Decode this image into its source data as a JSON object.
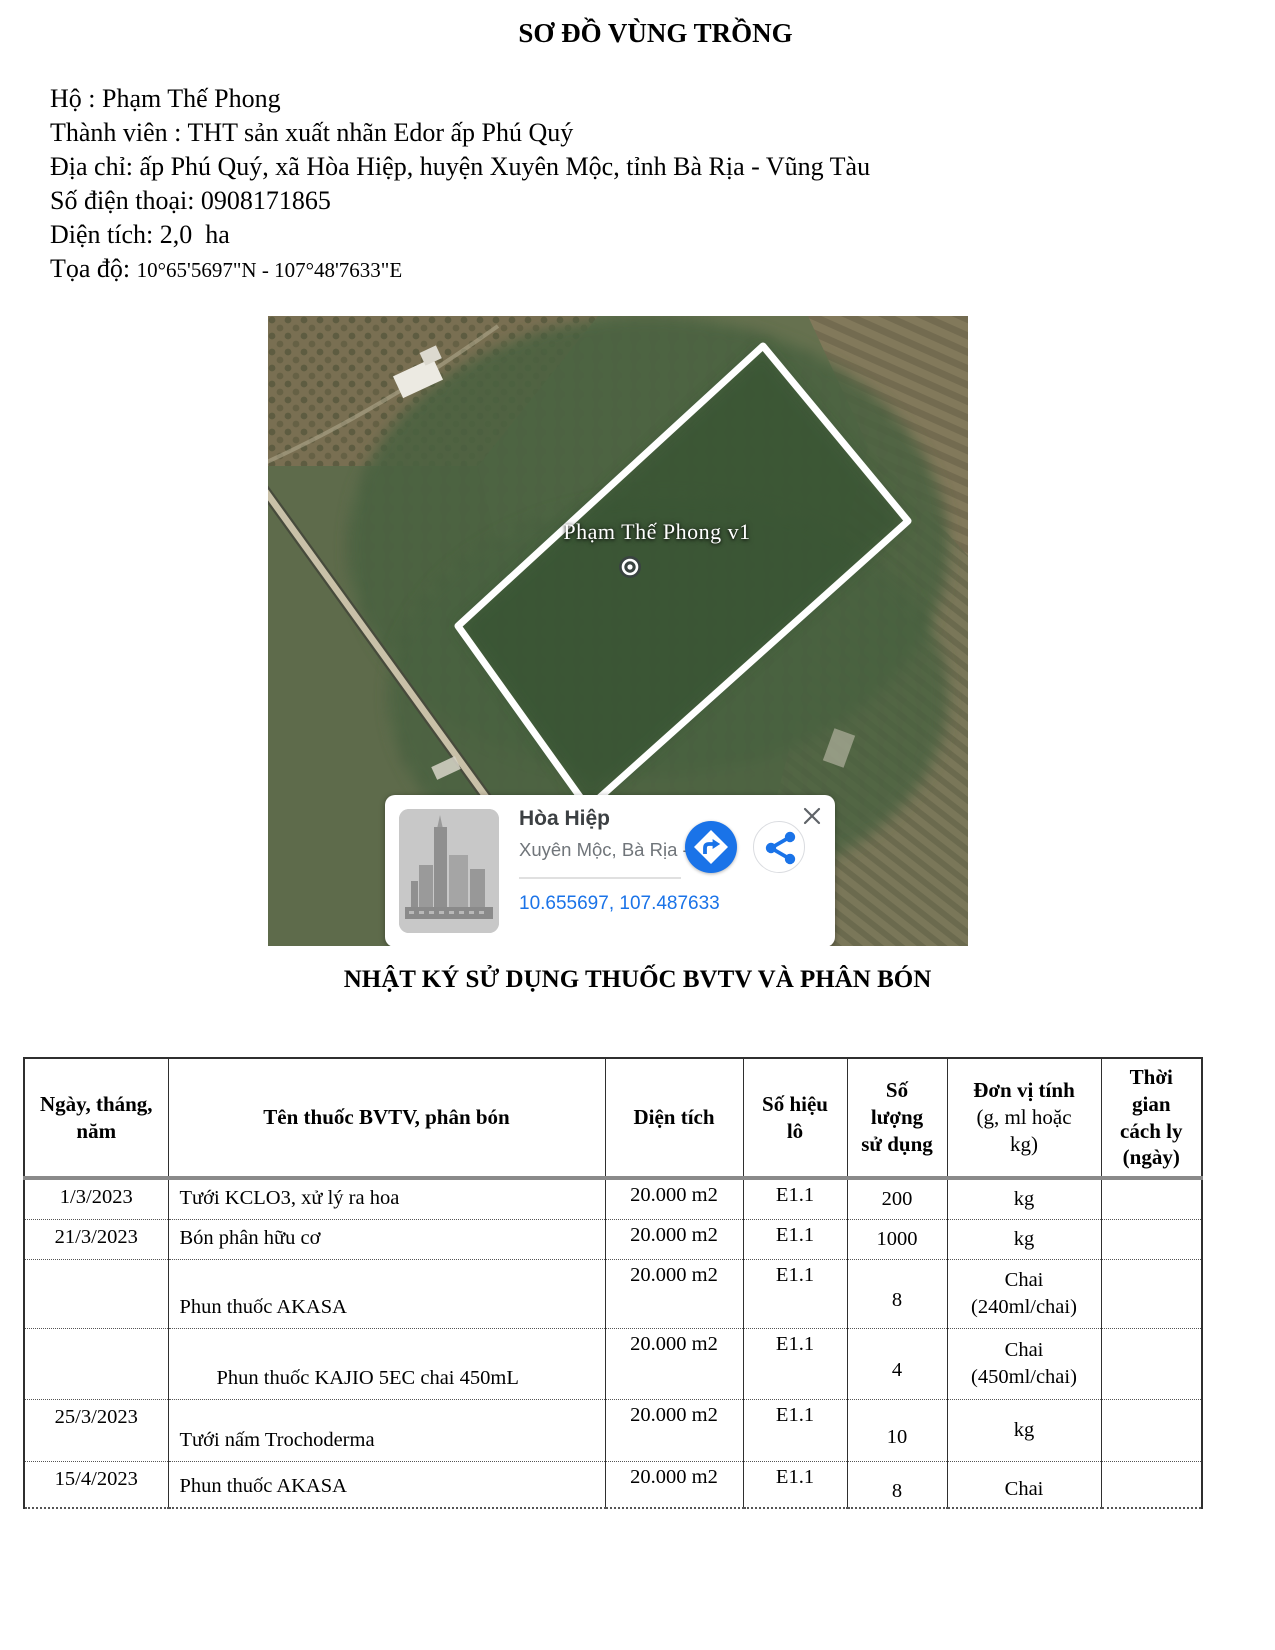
{
  "header": {
    "title": "SƠ ĐỒ VÙNG TRỒNG"
  },
  "info": {
    "lines": [
      {
        "text": "Hộ : Phạm Thế Phong"
      },
      {
        "text": "Thành viên : THT sản xuất nhãn Edor ấp Phú Quý"
      },
      {
        "text": "Địa chỉ: ấp Phú Quý, xã Hòa Hiệp, huyện Xuyên Mộc, tỉnh Bà Rịa - Vũng Tàu"
      },
      {
        "text": "Số điện thoại: 0908171865"
      },
      {
        "text": "Diện tích: 2,0  ha"
      },
      {
        "text": "Tọa độ: ",
        "value": "10°65'5697\"N - 107°48'7633\"E"
      }
    ]
  },
  "map": {
    "area_label": "Phạm Thế Phong v1",
    "card": {
      "title": "Hòa Hiệp",
      "subtitle": "Xuyên Mộc, Bà Rịa - Vũn...",
      "coordinates": "10.655697, 107.487633"
    }
  },
  "log": {
    "title": "NHẬT KÝ SỬ DỤNG THUỐC BVTV VÀ PHÂN BÓN",
    "columns": [
      {
        "label": "Ngày, tháng, năm"
      },
      {
        "label": "Tên thuốc BVTV, phân bón"
      },
      {
        "label": "Diện tích"
      },
      {
        "label": "Số hiệu lô"
      },
      {
        "label": "Số lượng sử dụng"
      },
      {
        "label": "Đơn vị tính",
        "sub": "(g, ml hoặc kg)"
      },
      {
        "label": "Thời gian cách ly (ngày)"
      }
    ],
    "rows": [
      [
        "1/3/2023",
        "Tưới KCLO3, xử lý ra hoa",
        "20.000 m2",
        "E1.1",
        "200",
        "kg",
        ""
      ],
      [
        "21/3/2023",
        "Bón phân hữu cơ",
        "20.000 m2",
        "E1.1",
        "1000",
        "kg",
        ""
      ],
      [
        "",
        "Phun thuốc AKASA",
        "20.000 m2",
        "E1.1",
        "8",
        "Chai\n(240ml/chai)",
        ""
      ],
      [
        "",
        "Phun thuốc KAJIO 5EC chai 450mL",
        "20.000 m2",
        "E1.1",
        "4",
        "Chai\n(450ml/chai)",
        ""
      ],
      [
        "25/3/2023",
        "Tưới nấm Trochoderma",
        "20.000 m2",
        "E1.1",
        "10",
        "kg",
        ""
      ],
      [
        "15/4/2023",
        "Phun thuốc AKASA",
        "20.000 m2",
        "E1.1",
        "8",
        "Chai",
        ""
      ]
    ]
  }
}
